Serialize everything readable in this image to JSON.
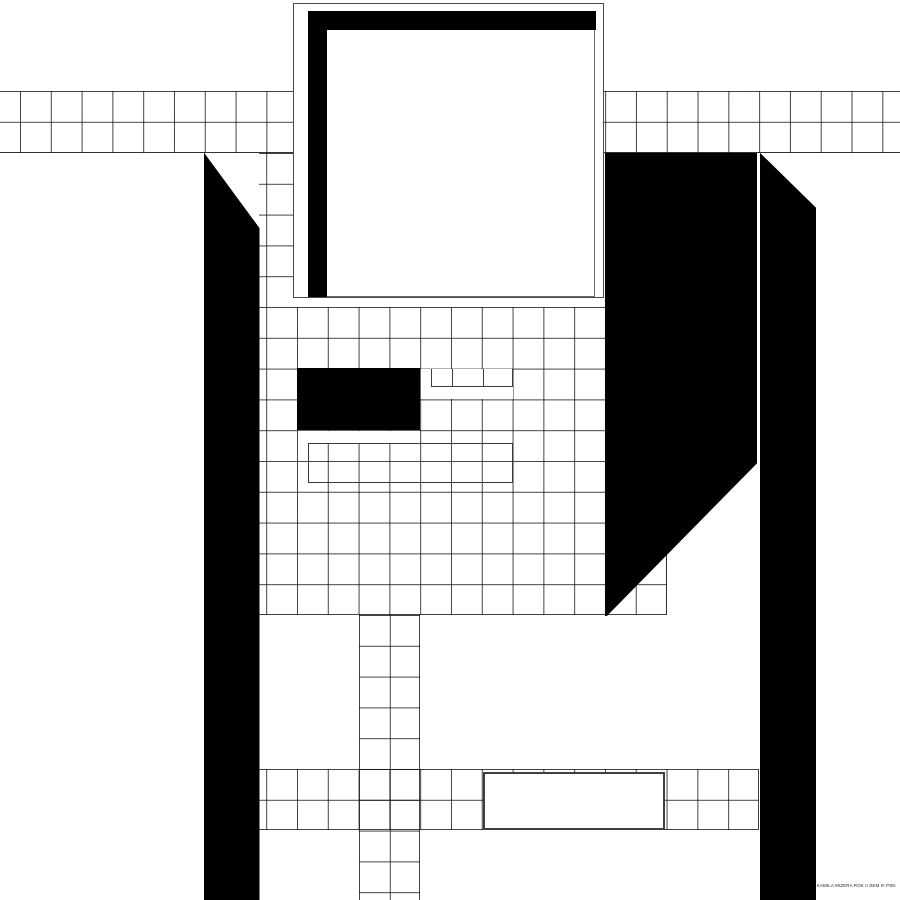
{
  "artwork": {
    "caption": "KAMILA MIZERA ROK II SEM III PSD",
    "colors": {
      "background": "#ffffff",
      "shapes": "#000000",
      "grid_lines": "#3d3d3d",
      "box_outlines": "#3f3f3f"
    }
  }
}
